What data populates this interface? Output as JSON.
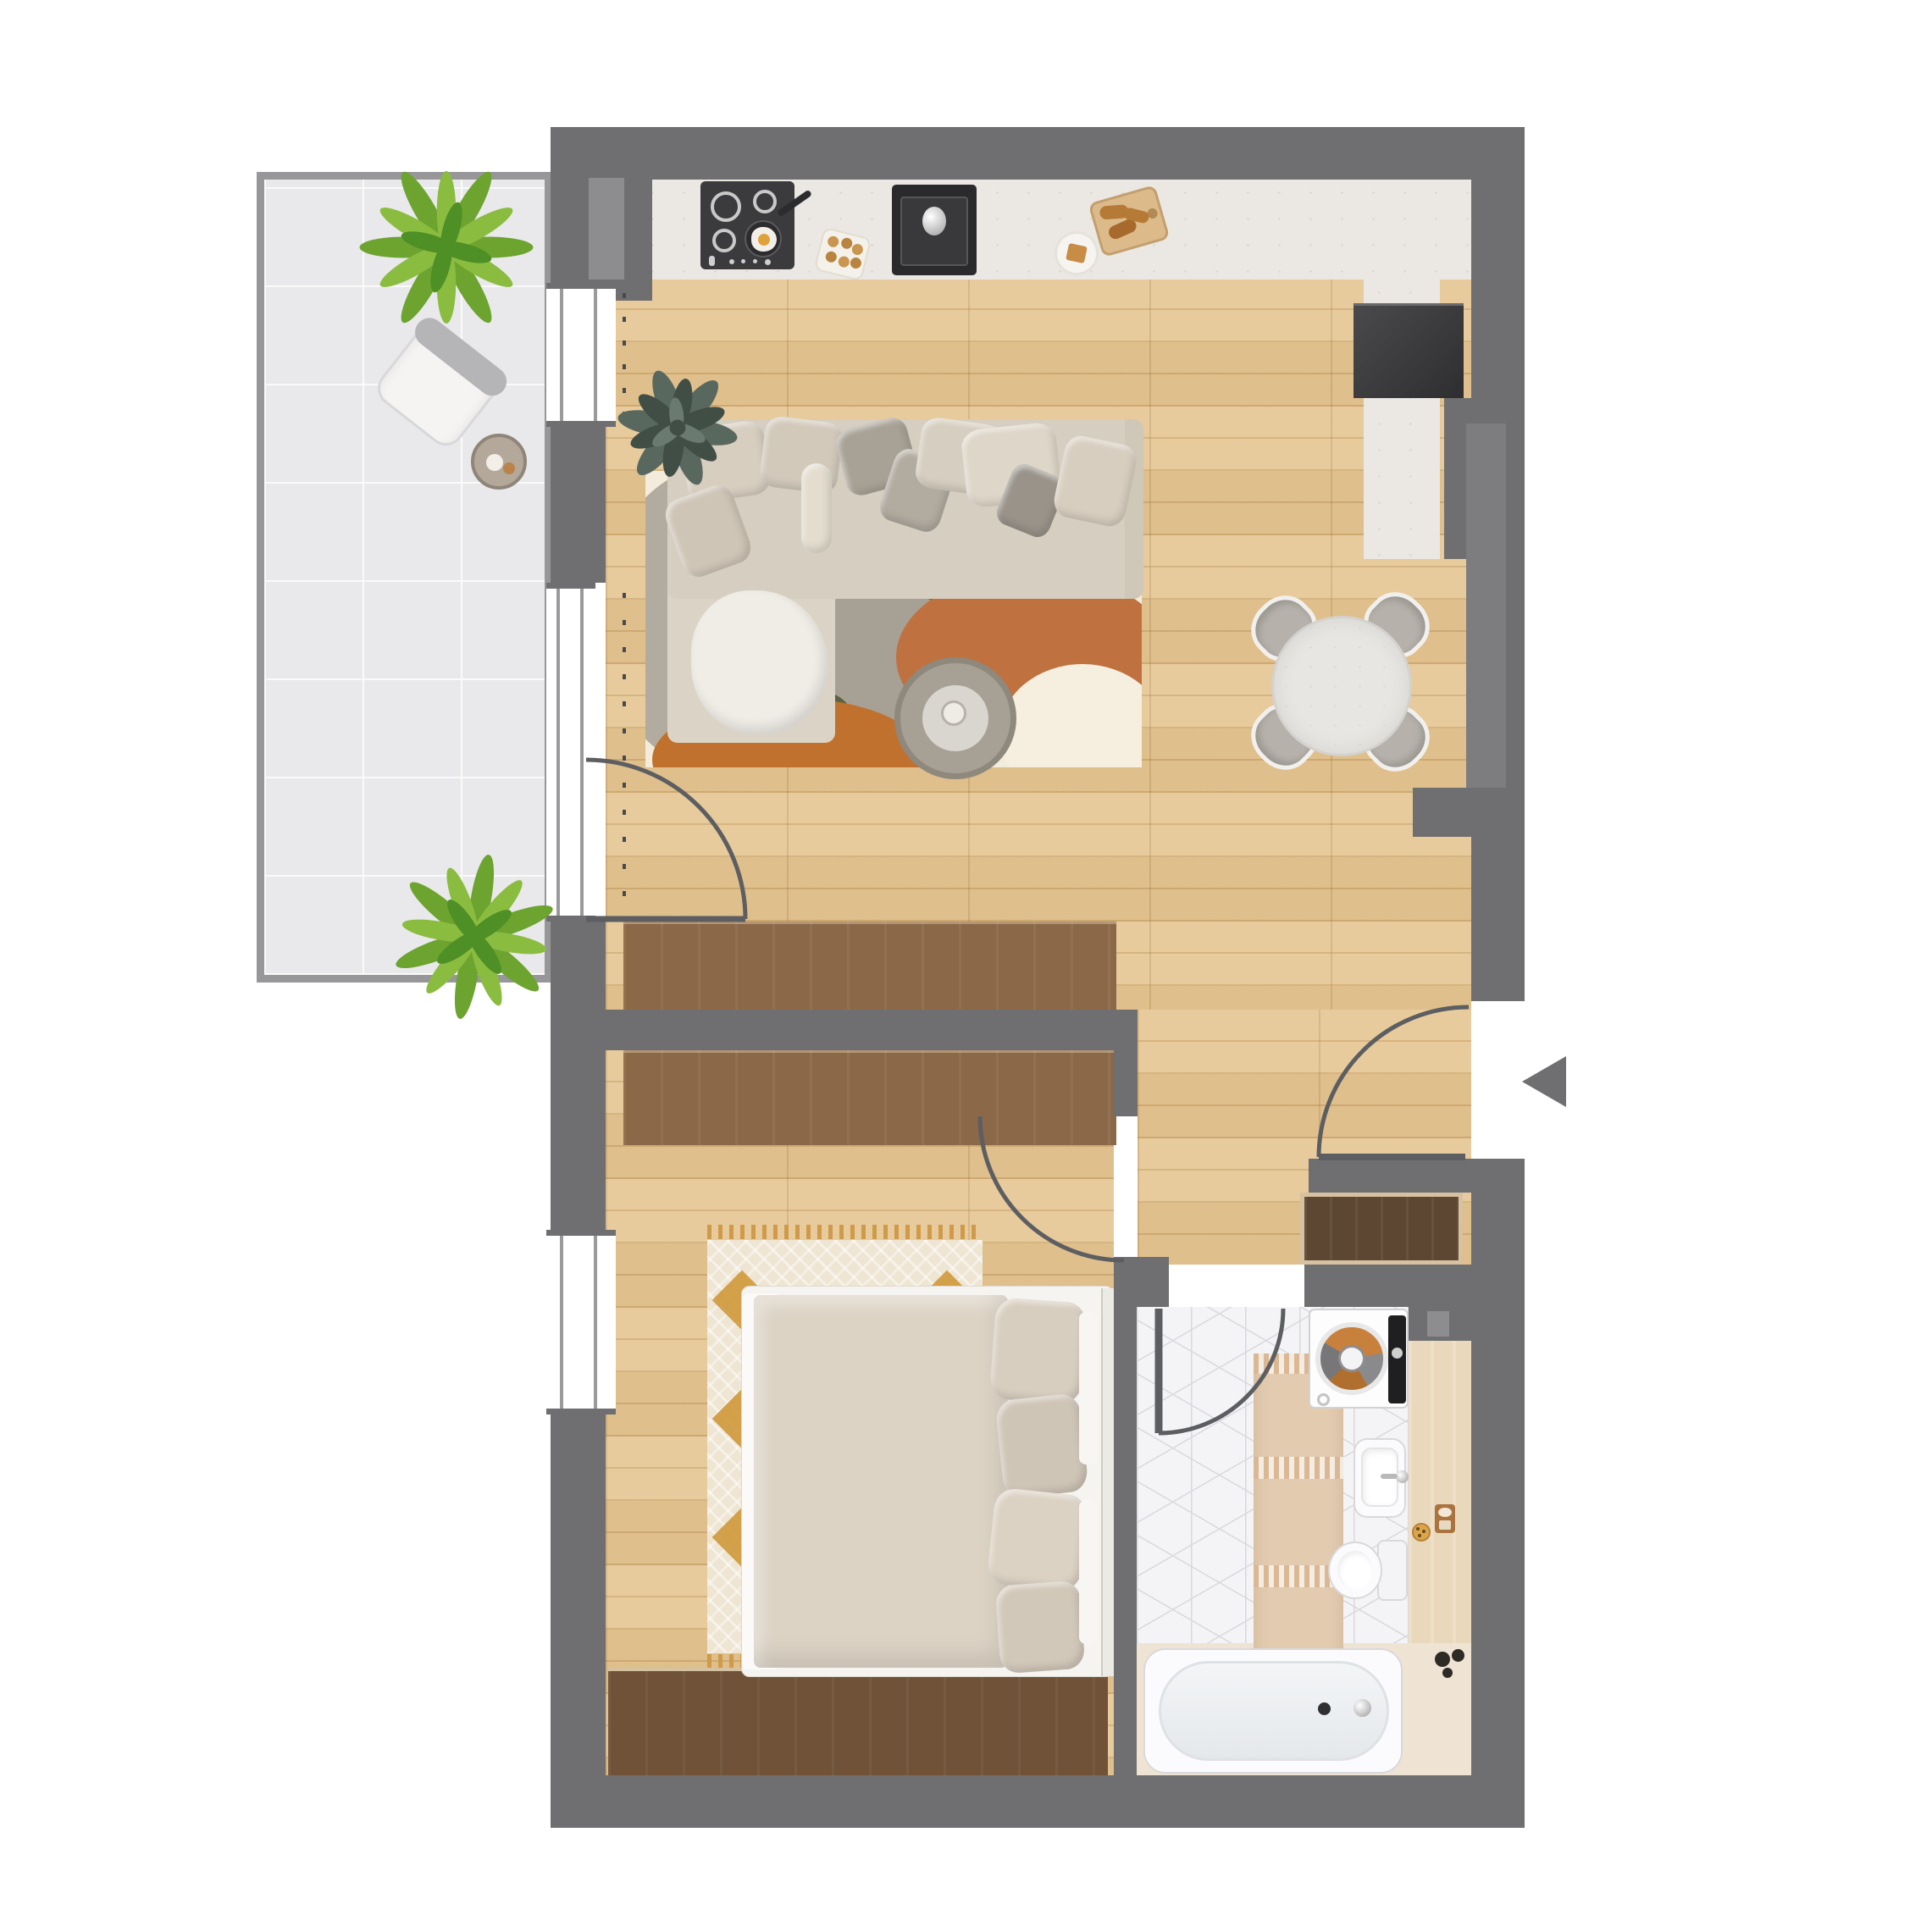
{
  "plan": {
    "kind": "apartment-floor-plan-top-view",
    "rooms": {
      "balcony": {
        "items": [
          "potted-plant",
          "armchair",
          "side-table",
          "potted-plant"
        ]
      },
      "kitchen": {
        "items": [
          "countertop",
          "cooktop-4-burners",
          "frying-pan-with-egg",
          "sink",
          "refrigerator",
          "cutting-board",
          "plate",
          "egg-tray"
        ]
      },
      "living-room": {
        "items": [
          "corner-sofa",
          "pillows",
          "throw-blanket",
          "potted-plant",
          "area-rug",
          "coffee-table",
          "dining-table",
          "dining-chair",
          "dining-chair",
          "dining-chair",
          "dining-chair",
          "wardrobe"
        ]
      },
      "bedroom": {
        "items": [
          "double-bed",
          "pillows",
          "patterned-rug",
          "wardrobe",
          "wardrobe-low"
        ]
      },
      "hallway": {
        "items": [
          "entrance-door",
          "shoe-cabinet"
        ]
      },
      "bathroom": {
        "items": [
          "washing-machine",
          "runner-rug",
          "washbasin",
          "toilet",
          "bathtub",
          "cosmetics-tray",
          "pebbles-decor"
        ]
      }
    },
    "symbols": {
      "entrance-arrow": "triangle-pointing-left",
      "door-swing": "quarter-circle-arc",
      "window-ticks": "dotted-line",
      "windows": "white-gaps-in-wall"
    }
  },
  "colors": {
    "wall": "#6f6e70",
    "wallLight": "#8d8d8f",
    "wallPanel": "#7d7d7f",
    "arc": "#5c5e61",
    "wood": "#e5c795",
    "woodLine": "#d3ae77",
    "woodDark": "#8b6848",
    "woodDarker": "#6f5238",
    "closet": "#5d4733",
    "closetTrim": "#d6c1a0",
    "tile": "#e9e9eb",
    "tileLine": "#fafafa",
    "balconyBorder": "#97979a",
    "counter": "#ebe8e4",
    "speck": "#cfc9bf",
    "appliance": "#3b3b3d",
    "applianceDark": "#2a2a2c",
    "bathTile": "#f4f4f7",
    "bathLine": "#d9d9de",
    "deck": "#efe4d3",
    "ledge": "#e9d8bc",
    "white": "#fbfbfd",
    "fixtureLine": "#d9d9db",
    "sofa": "#d6cec0",
    "sofaChaise": "#dbd4c6",
    "blanket": "#f0ede7",
    "rugCream": "#f3ebdb",
    "rugGray": "#b2aca0",
    "rugGrayCirc": "#a7a095",
    "rugTerra": "#bf7140",
    "rugBrown": "#8e5a33",
    "rugGreen": "#5a6342",
    "rugOrange": "#c0712e",
    "tableTop": "#e8e6e2",
    "chairSeat": "#b6b2ab",
    "chairFrame": "#f2f0ed",
    "bedBase": "#f6f4f0",
    "duvet": "#dcd3c5",
    "pillowA": "#d8cec0",
    "pillowB": "#cfc5b7",
    "bedRug": "#eee5d3",
    "bedRugAccent": "#d09a3e",
    "fringe": "#cf9a4a",
    "runner": "#e3cbb0",
    "runnerFringe": "#d9b893",
    "plantG1": "#6da32f",
    "plantG2": "#8abc3f",
    "plantG3": "#4e8f26",
    "plantD1": "#59685e",
    "plantD2": "#414e46",
    "plantD3": "#6b7a70",
    "drumClothes1": "#c8803d",
    "drumClothes2": "#8a8a8c",
    "drumClothes3": "#b06f2e",
    "drumClothes4": "#77777a",
    "egg": "#dfa23b",
    "board": "#dcba8a",
    "croissant": "#b67a37",
    "armTable": "#b4a89a"
  }
}
